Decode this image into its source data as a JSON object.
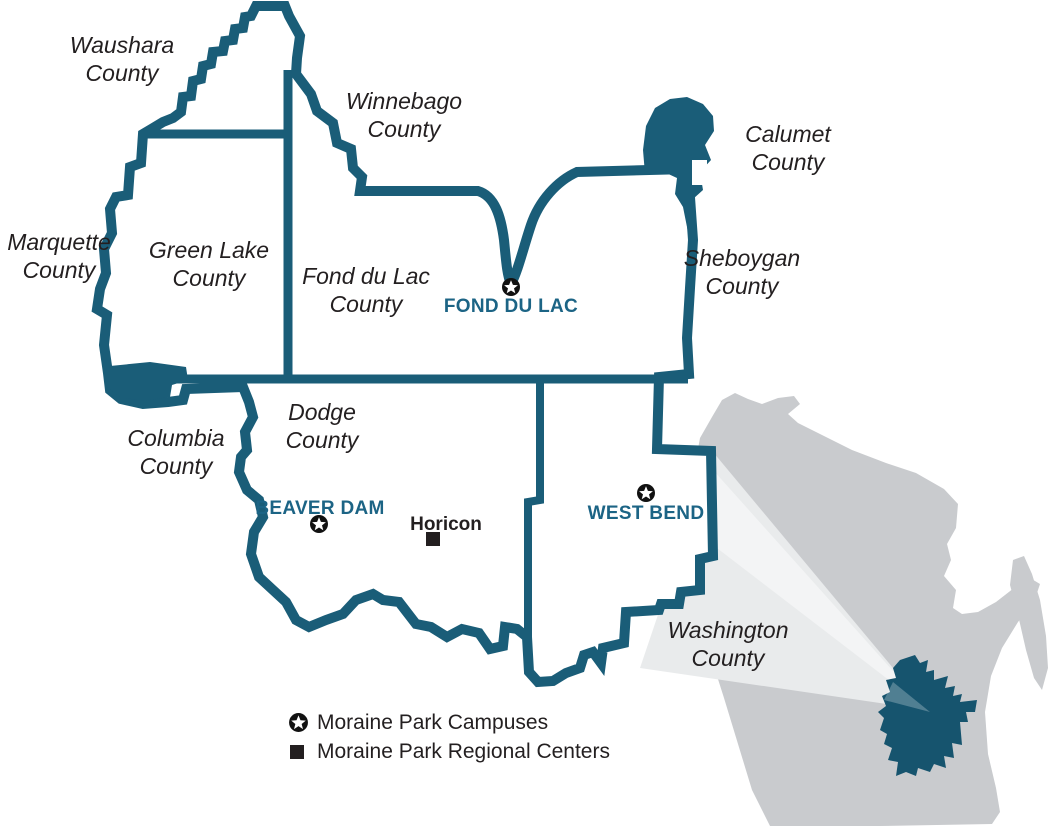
{
  "colors": {
    "district_line": "#1a5d78",
    "campus_text": "#1c6485",
    "label_text": "#231f20",
    "state_fill": "#c9cbce",
    "beam_fill": "#e9ebec"
  },
  "counties": [
    {
      "id": "waushara",
      "line1": "Waushara",
      "line2": "County"
    },
    {
      "id": "winnebago",
      "line1": "Winnebago",
      "line2": "County"
    },
    {
      "id": "calumet",
      "line1": "Calumet",
      "line2": "County"
    },
    {
      "id": "marquette",
      "line1": "Marquette",
      "line2": "County"
    },
    {
      "id": "green-lake",
      "line1": "Green Lake",
      "line2": "County"
    },
    {
      "id": "fond-du-lac",
      "line1": "Fond du Lac",
      "line2": "County"
    },
    {
      "id": "sheboygan",
      "line1": "Sheboygan",
      "line2": "County"
    },
    {
      "id": "dodge",
      "line1": "Dodge",
      "line2": "County"
    },
    {
      "id": "columbia",
      "line1": "Columbia",
      "line2": "County"
    },
    {
      "id": "washington",
      "line1": "Washington",
      "line2": "County"
    }
  ],
  "campuses": [
    {
      "id": "fond-du-lac-campus",
      "name": "FOND DU LAC"
    },
    {
      "id": "beaver-dam-campus",
      "name": "BEAVER DAM"
    },
    {
      "id": "west-bend-campus",
      "name": "WEST BEND"
    }
  ],
  "regional_centers": [
    {
      "id": "horicon-center",
      "name": "Horicon"
    }
  ],
  "legend": {
    "campuses_label": "Moraine Park Campuses",
    "regional_centers_label": "Moraine Park Regional Centers"
  }
}
